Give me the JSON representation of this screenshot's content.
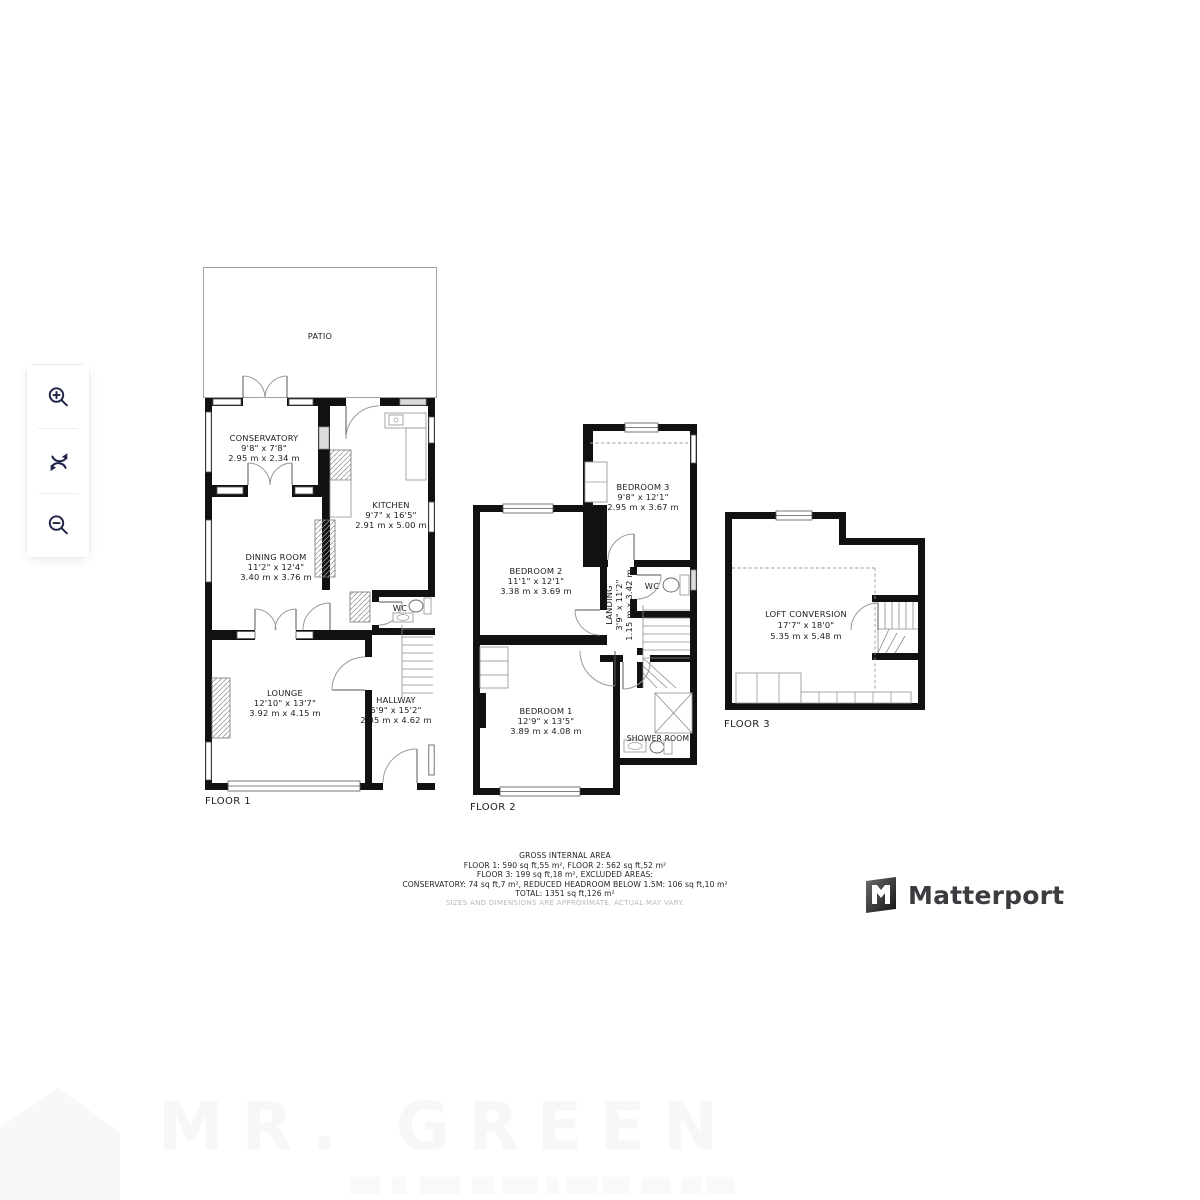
{
  "controls": {
    "zoom_in_icon": "magnifier-plus",
    "rotate_icon": "circular-arrows",
    "zoom_out_icon": "magnifier-minus"
  },
  "floors": [
    {
      "label": "FLOOR 1",
      "patio": "PATIO",
      "rooms": {
        "conservatory": {
          "name": "CONSERVATORY",
          "imperial": "9'8\" x 7'8\"",
          "metric": "2.95 m x 2.34 m"
        },
        "kitchen": {
          "name": "KITCHEN",
          "imperial": "9'7\" x 16'5\"",
          "metric": "2.91 m x 5.00 m"
        },
        "dining": {
          "name": "DINING ROOM",
          "imperial": "11'2\" x 12'4\"",
          "metric": "3.40 m x 3.76 m"
        },
        "lounge": {
          "name": "LOUNGE",
          "imperial": "12'10\" x 13'7\"",
          "metric": "3.92 m x 4.15 m"
        },
        "hallway": {
          "name": "HALLWAY",
          "imperial": "6'9\" x 15'2\"",
          "metric": "2.05 m x 4.62 m"
        },
        "wc": {
          "name": "WC"
        }
      }
    },
    {
      "label": "FLOOR 2",
      "rooms": {
        "bedroom3": {
          "name": "BEDROOM 3",
          "imperial": "9'8\" x 12'1\"",
          "metric": "2.95 m x 3.67 m"
        },
        "bedroom2": {
          "name": "BEDROOM 2",
          "imperial": "11'1\" x 12'1\"",
          "metric": "3.38 m x 3.69 m"
        },
        "bedroom1": {
          "name": "BEDROOM 1",
          "imperial": "12'9\" x 13'5\"",
          "metric": "3.89 m x 4.08 m"
        },
        "landing": {
          "name": "LANDING",
          "imperial": "3'9\" x 11'2\"",
          "metric": "1.15 m x 3.42 m"
        },
        "wc": {
          "name": "WC"
        },
        "shower": {
          "name": "SHOWER ROOM"
        }
      }
    },
    {
      "label": "FLOOR 3",
      "rooms": {
        "loft": {
          "name": "LOFT CONVERSION",
          "imperial": "17'7\" x 18'0\"",
          "metric": "5.35 m x 5.48 m"
        }
      }
    }
  ],
  "summary": {
    "title": "GROSS INTERNAL AREA",
    "line1": "FLOOR 1: 590 sq ft,55 m², FLOOR 2: 562 sq ft,52 m²",
    "line2": "FLOOR 3: 199 sq ft,18 m², EXCLUDED AREAS:",
    "line3": "CONSERVATORY: 74 sq ft,7 m², REDUCED HEADROOM BELOW 1.5M: 106 sq ft,10 m²",
    "line4": "TOTAL: 1351 sq ft,126 m²",
    "disclaimer": "SIZES AND DIMENSIONS ARE APPROXIMATE, ACTUAL MAY VARY."
  },
  "branding": {
    "logo_text": "Matterport"
  },
  "watermark": {
    "text": "MR. GREEN"
  },
  "colors": {
    "wall": "#111111",
    "control_icon": "#1f2347",
    "label_text": "#1b1b1b",
    "disclaimer_text": "#b9b9b9",
    "logo_text": "#3b3b40",
    "watermark": "#f7f7f7"
  }
}
